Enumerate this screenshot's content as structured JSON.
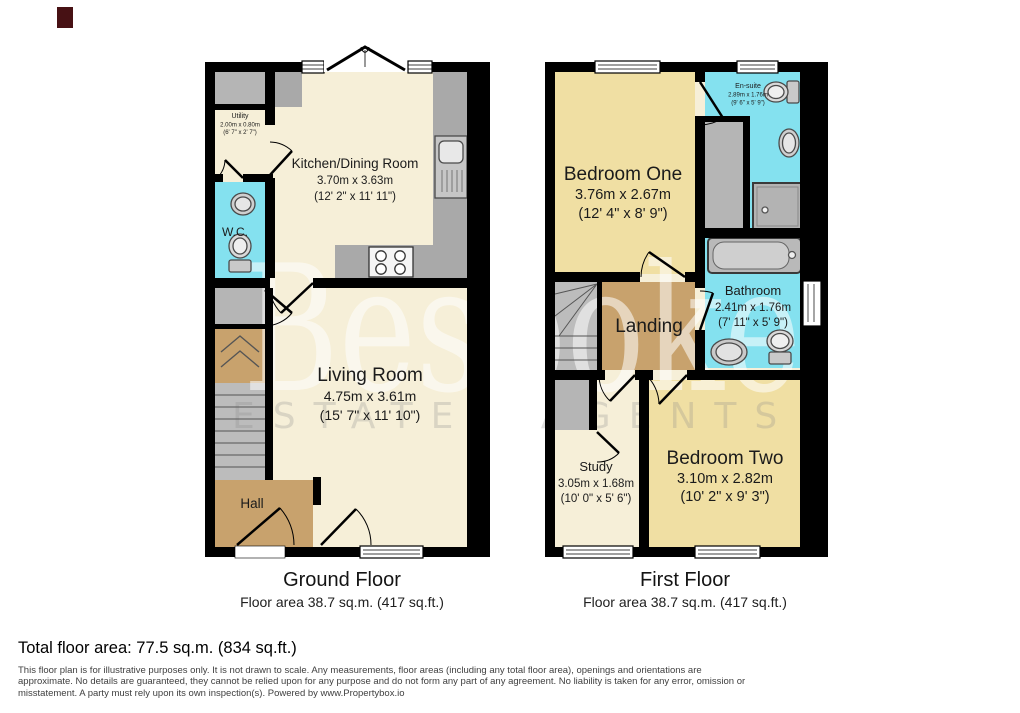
{
  "watermark": {
    "brand": "Bespoke",
    "tagline": "ESTATE AGENTS"
  },
  "colors": {
    "floor_cream": "#f6efd8",
    "bedroom_yellow": "#f0dfa3",
    "wet_cyan": "#84e1ef",
    "hall_tan": "#c8a26d",
    "counter_gray": "#a9a9a9",
    "fixture_gray": "#b5b5b5",
    "wall_black": "#000000",
    "logo_red": "#471114"
  },
  "ground_floor": {
    "title": "Ground Floor",
    "area": "Floor area 38.7 sq.m. (417 sq.ft.)",
    "rooms": {
      "utility": {
        "name": "Utility",
        "metric": "2.00m x 0.80m",
        "imperial": "(6' 7\" x 2' 7\")"
      },
      "wc": {
        "name": "W.C."
      },
      "kitchen": {
        "name": "Kitchen/Dining Room",
        "metric": "3.70m x 3.63m",
        "imperial": "(12' 2\" x 11' 11\")"
      },
      "living": {
        "name": "Living Room",
        "metric": "4.75m x 3.61m",
        "imperial": "(15' 7\" x 11' 10\")"
      },
      "hall": {
        "name": "Hall"
      }
    }
  },
  "first_floor": {
    "title": "First Floor",
    "area": "Floor area 38.7 sq.m. (417 sq.ft.)",
    "rooms": {
      "bedroom_one": {
        "name": "Bedroom One",
        "metric": "3.76m x 2.67m",
        "imperial": "(12' 4\" x 8' 9\")"
      },
      "ensuite": {
        "name": "En-suite",
        "metric": "2.89m x 1.76m",
        "imperial": "(9' 6\" x 5' 9\")"
      },
      "bathroom": {
        "name": "Bathroom",
        "metric": "2.41m x 1.76m",
        "imperial": "(7' 11\" x 5' 9\")"
      },
      "landing": {
        "name": "Landing"
      },
      "study": {
        "name": "Study",
        "metric": "3.05m x 1.68m",
        "imperial": "(10' 0\" x 5' 6\")"
      },
      "bedroom_two": {
        "name": "Bedroom Two",
        "metric": "3.10m x 2.82m",
        "imperial": "(10' 2\" x 9' 3\")"
      }
    }
  },
  "footer": {
    "total": "Total floor area: 77.5 sq.m. (834 sq.ft.)",
    "disclaimer_lines": [
      "This floor plan is for illustrative purposes only. It is not drawn to scale. Any measurements, floor areas (including any total floor area), openings and orientations are",
      "approximate. No details are guaranteed, they cannot be relied upon for any purpose and do not form any part of any agreement. No liability is taken for any error, omission or",
      "misstatement. A party must rely upon its own inspection(s). Powered by www.Propertybox.io"
    ]
  }
}
